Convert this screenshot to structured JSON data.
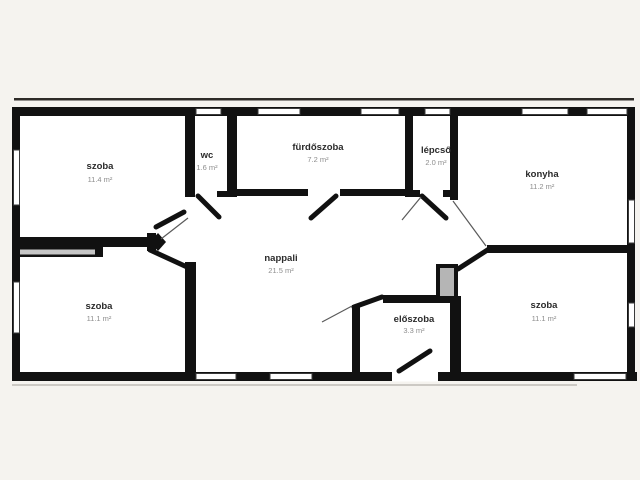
{
  "canvas": {
    "background_color": "#f5f3ef",
    "wall_color": "#111111",
    "room_fill_color": "#ffffff",
    "window_fill_color": "#ffffff",
    "shaft_fill_color": "#b5b5b5"
  },
  "floorplan": {
    "type": "apartment-floor-plan",
    "language": "hungarian",
    "rooms": [
      {
        "id": "szoba-top-left",
        "name": "szoba",
        "area": "11.4 m²"
      },
      {
        "id": "wc",
        "name": "wc",
        "area": "1.6 m²"
      },
      {
        "id": "furdoszoba",
        "name": "fürdőszoba",
        "area": "7.2 m²"
      },
      {
        "id": "lepcso",
        "name": "lépcső",
        "area": "2.0 m²"
      },
      {
        "id": "konyha",
        "name": "konyha",
        "area": "11.2 m²"
      },
      {
        "id": "nappali",
        "name": "nappali",
        "area": "21.5 m²"
      },
      {
        "id": "szoba-bottom-left",
        "name": "szoba",
        "area": "11.1 m²"
      },
      {
        "id": "eloszoba",
        "name": "előszoba",
        "area": "3.3 m²"
      },
      {
        "id": "szoba-bottom-right",
        "name": "szoba",
        "area": "11.1 m²"
      }
    ]
  }
}
